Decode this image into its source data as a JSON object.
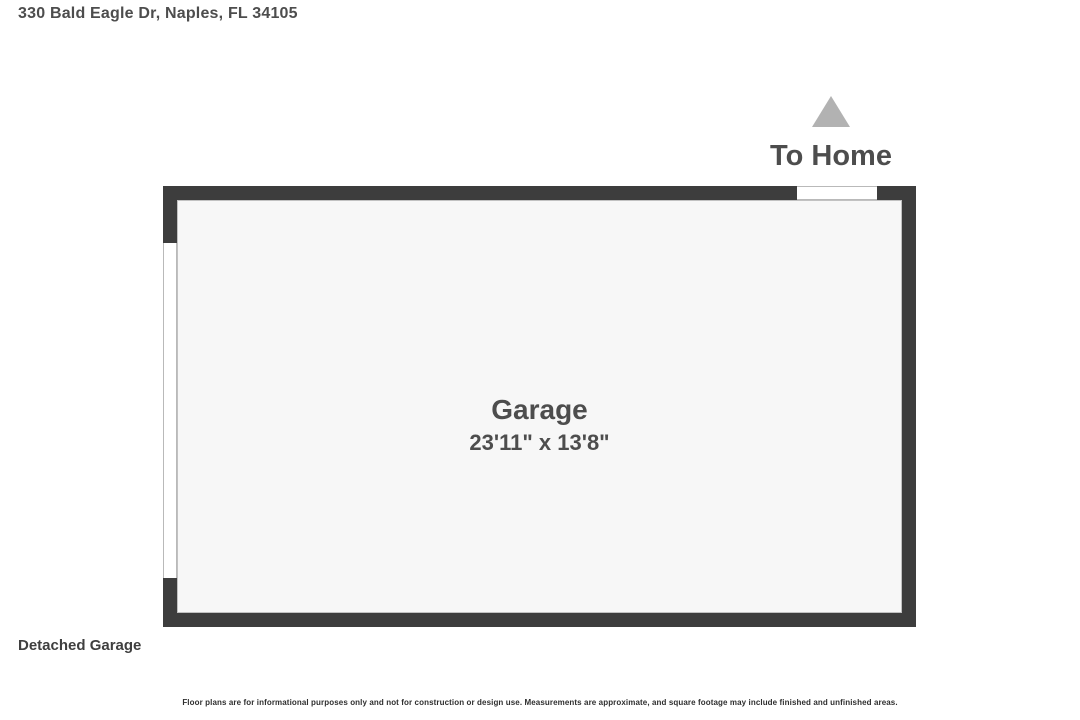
{
  "page": {
    "address": "330 Bald Eagle Dr, Naples, FL 34105",
    "plan_label": "Detached Garage",
    "disclaimer": "Floor plans are for informational purposes only and not for construction or design use. Measurements are approximate, and square footage may include finished and unfinished areas."
  },
  "floor_plan": {
    "to_home_label": "To Home",
    "room": {
      "name": "Garage",
      "dimensions": "23'11\" x 13'8\""
    },
    "openings": [
      {
        "name": "home-door-opening",
        "wall": "top"
      },
      {
        "name": "garage-door-opening",
        "wall": "left"
      }
    ],
    "colors": {
      "wall": "#3d3d3d",
      "floor": "#f7f7f7",
      "arrow": "#b2b2b2",
      "text": "#4d4d4d"
    }
  }
}
